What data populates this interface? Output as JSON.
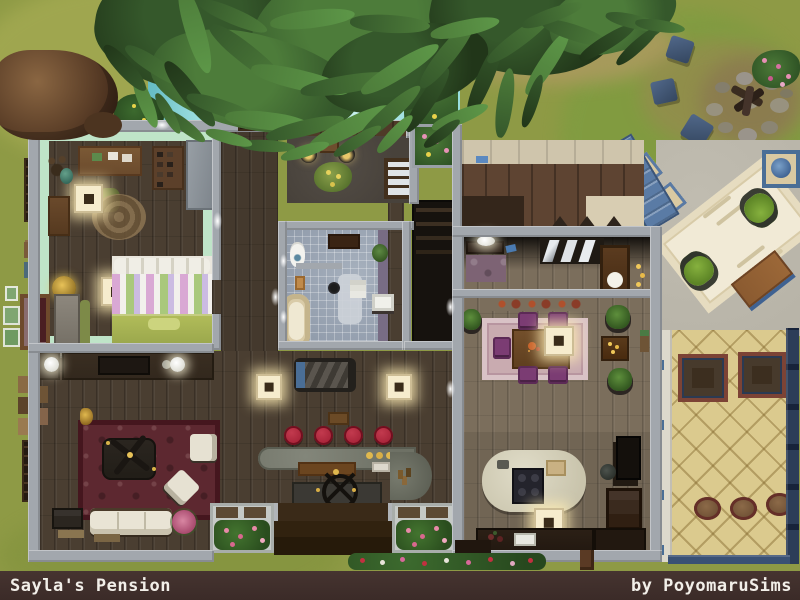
{
  "footer": {
    "title": "Sayla's Pension",
    "credit": "by PoyomaruSims"
  },
  "colors": {
    "grass": "#8e9a45",
    "grass_light": "#a4aa52",
    "grass_dark": "#7e9c40",
    "dirt": "#b09a62",
    "water": "#89d5d8",
    "water_light": "#c6f0ee",
    "wall": "#a2a7ad",
    "wood_floor": "#4a3e31",
    "wood_floor_light": "#7b6e5c",
    "deck_wood": "#5e4432",
    "mint_wall": "#bfe4c8",
    "stone_floor": "#48423b",
    "tile_blue": "#8d98a8",
    "tile_sand": "#dbca8e",
    "concrete": "#b7b3a7",
    "rug_red": "#5d2830",
    "rug_pink": "#c9abb0",
    "rug_cream": "#f1ead6",
    "stool_red": "#a62338",
    "chair_purple": "#7b3c73",
    "navy": "#3a5174",
    "leaf_dark": "#213619",
    "leaf_mid": "#35582b",
    "leaf_light": "#4d7c3a",
    "footer_bg": "#3b2b28",
    "footer_text": "#f2efe9"
  }
}
